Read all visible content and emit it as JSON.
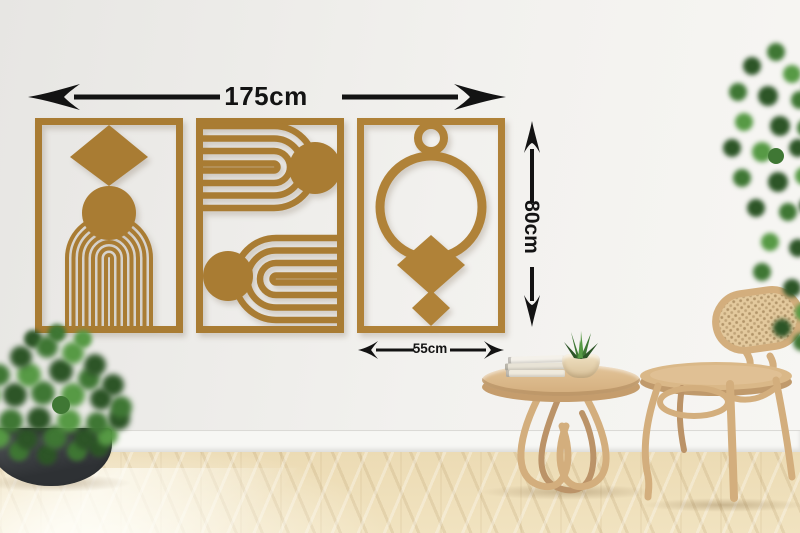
{
  "annotations": {
    "width_label": "175cm",
    "height_label": "80cm",
    "panel_width_label": "55cm"
  },
  "artwork": {
    "panels": [
      {
        "motif": "diamond-circle-arch"
      },
      {
        "motif": "double-arch-with-suns"
      },
      {
        "motif": "rings-with-diamonds"
      }
    ]
  },
  "colors": {
    "panel-gold": "#a97c33",
    "panel-gold-light": "#b08238",
    "ink": "#131313",
    "wood": "#d3ae7d",
    "wood-dark": "#bb9368",
    "leaf-dark": "#2d5527",
    "leaf-mid": "#3f7734",
    "leaf-light": "#579a45"
  }
}
